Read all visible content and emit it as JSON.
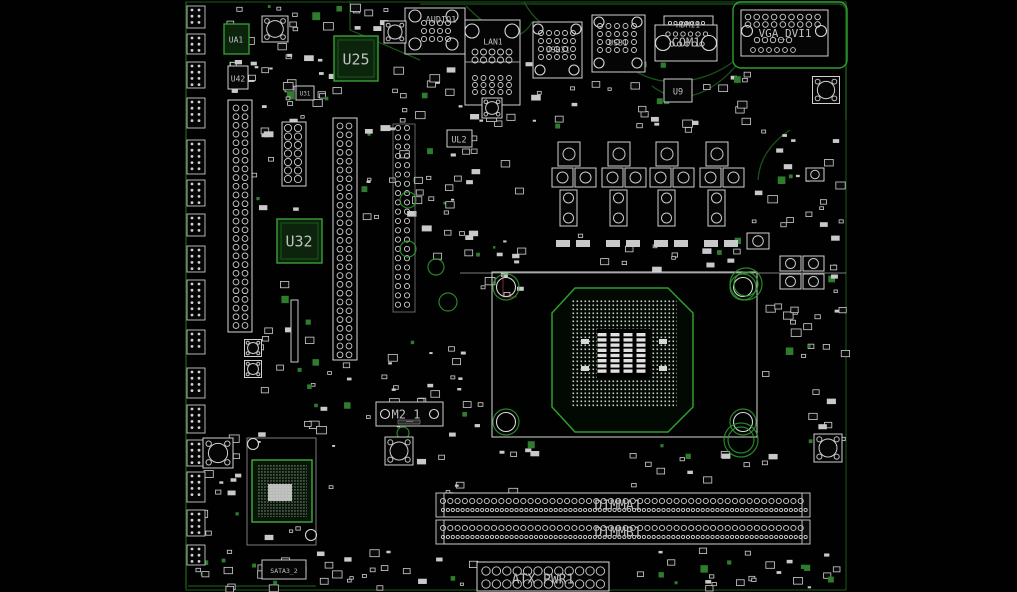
{
  "io": {
    "audio": "AUDIO1",
    "lan": "LAN1",
    "usb3": "USB31",
    "usb": "USB1",
    "hdmi": "HDMI1",
    "com": "COM1",
    "vga": "VGA_DVI1"
  },
  "chips": {
    "ua1": "UA1",
    "u42": "U42",
    "u31": "U31",
    "u25": "U25",
    "u9": "U9",
    "ul2": "UL2",
    "u32": "U32"
  },
  "slots": {
    "dimm_a": "DIMMA1",
    "dimm_b": "DIMMB1",
    "m2": "M2_1",
    "sata": "SATA3_2",
    "atx": "ATX PWR1"
  },
  "colors": {
    "board_outline": "#1a5c1a",
    "bright_green": "#3fae3f",
    "silkscreen": "#d0d0d0",
    "chip_fill": "#0c240c",
    "background": "#010101",
    "dimm_label": "#8fb48f"
  },
  "scene": {
    "board": {
      "x": 186,
      "y": 2,
      "w": 660,
      "h": 588
    },
    "clusters": [
      [
        218,
        4,
        115,
        96,
        40,
        1
      ],
      [
        392,
        58,
        255,
        66,
        40,
        2
      ],
      [
        650,
        62,
        95,
        66,
        18,
        3
      ],
      [
        250,
        100,
        80,
        110,
        16,
        4
      ],
      [
        360,
        125,
        92,
        100,
        20,
        5
      ],
      [
        420,
        132,
        100,
        135,
        24,
        6
      ],
      [
        745,
        130,
        98,
        98,
        22,
        7
      ],
      [
        760,
        300,
        84,
        168,
        26,
        8
      ],
      [
        828,
        232,
        17,
        78,
        8,
        9
      ],
      [
        362,
        340,
        118,
        98,
        28,
        10
      ],
      [
        415,
        438,
        118,
        58,
        14,
        11
      ],
      [
        188,
        428,
        148,
        115,
        28,
        12
      ],
      [
        190,
        548,
        288,
        40,
        38,
        13
      ],
      [
        620,
        548,
        224,
        40,
        28,
        14
      ],
      [
        480,
        240,
        40,
        58,
        8,
        15
      ],
      [
        255,
        272,
        58,
        116,
        13,
        16
      ],
      [
        300,
        362,
        58,
        66,
        10,
        17
      ],
      [
        620,
        440,
        128,
        44,
        12,
        18
      ],
      [
        540,
        232,
        200,
        36,
        14,
        19
      ],
      [
        308,
        4,
        80,
        30,
        10,
        20
      ]
    ],
    "headers": {
      "x": 187,
      "w": 18,
      "items": [
        [
          6,
          22
        ],
        [
          34,
          20
        ],
        [
          62,
          26
        ],
        [
          98,
          30
        ],
        [
          140,
          34
        ],
        [
          180,
          26
        ],
        [
          214,
          22
        ],
        [
          246,
          26
        ],
        [
          280,
          40
        ],
        [
          330,
          24
        ],
        [
          368,
          30
        ],
        [
          405,
          28
        ],
        [
          440,
          26
        ],
        [
          472,
          30
        ],
        [
          510,
          26
        ],
        [
          545,
          20
        ]
      ]
    },
    "iogrids": [
      [
        424,
        23,
        4,
        3,
        8,
        8,
        2.6
      ],
      [
        475,
        52,
        5,
        2,
        8.5,
        8,
        3
      ],
      [
        475,
        78,
        5,
        3,
        8.5,
        7,
        2.5
      ],
      [
        541,
        33,
        5,
        4,
        8,
        8,
        2.5
      ],
      [
        600,
        26,
        5,
        4,
        8.5,
        8,
        2.5
      ],
      [
        668,
        34,
        6,
        1,
        7.5,
        7,
        2.2
      ],
      [
        672,
        44,
        5,
        1,
        7.5,
        7,
        2.2
      ],
      [
        670,
        23,
        7,
        1,
        5.5,
        5,
        1.6
      ],
      [
        748,
        17,
        9,
        2,
        8.7,
        7.5,
        2.8
      ],
      [
        757,
        40,
        5,
        1,
        8,
        7,
        2.7
      ],
      [
        753,
        50,
        6,
        1,
        8,
        7,
        2.4
      ],
      [
        236,
        108,
        2,
        26,
        9,
        8.7,
        2.9
      ],
      [
        340,
        126,
        2,
        27,
        9,
        8.8,
        2.9
      ],
      [
        288,
        128,
        2,
        7,
        10,
        8.5,
        3.6
      ],
      [
        398,
        128,
        2,
        20,
        9,
        9.3,
        2.6
      ],
      [
        486,
        571,
        12,
        2,
        10.4,
        13,
        4.2
      ],
      [
        443,
        501,
        50,
        1,
        7.3,
        7,
        2.6
      ],
      [
        443,
        510,
        75,
        1,
        4.9,
        5,
        1.6
      ],
      [
        443,
        528,
        50,
        1,
        7.3,
        7,
        2.6
      ],
      [
        443,
        537,
        75,
        1,
        4.9,
        5,
        1.6
      ]
    ],
    "bigcircles": [
      [
        415,
        16,
        6
      ],
      [
        452,
        16,
        6
      ],
      [
        415,
        44,
        6
      ],
      [
        452,
        44,
        6
      ],
      [
        472,
        31,
        7
      ],
      [
        512,
        31,
        7
      ],
      [
        538,
        29,
        5
      ],
      [
        576,
        29,
        5
      ],
      [
        540,
        70,
        5
      ],
      [
        574,
        70,
        5
      ],
      [
        599,
        22,
        5
      ],
      [
        637,
        22,
        5
      ],
      [
        599,
        63,
        5
      ],
      [
        637,
        63,
        5
      ],
      [
        663,
        43,
        7.5
      ],
      [
        709,
        43,
        7.5
      ],
      [
        747,
        31,
        5.5
      ],
      [
        821,
        31,
        5.5
      ],
      [
        385,
        414,
        4.5
      ],
      [
        434,
        414,
        4.5
      ],
      [
        253,
        444,
        5.5
      ],
      [
        311,
        535,
        5.5
      ],
      [
        506,
        287,
        9.5
      ],
      [
        743,
        287,
        9.5
      ],
      [
        506,
        422,
        9.5
      ],
      [
        743,
        422,
        9.5
      ]
    ],
    "rings": [
      [
        506,
        287,
        13
      ],
      [
        743,
        287,
        13
      ],
      [
        506,
        422,
        13
      ],
      [
        743,
        422,
        13
      ],
      [
        408,
        200,
        8
      ],
      [
        408,
        249,
        8
      ],
      [
        436,
        267,
        8
      ],
      [
        448,
        302,
        9
      ],
      [
        746,
        284,
        12
      ],
      [
        746,
        284,
        16
      ],
      [
        741,
        440,
        13
      ],
      [
        741,
        440,
        17
      ],
      [
        403,
        433,
        6
      ]
    ],
    "machines": [
      [
        275,
        29,
        26
      ],
      [
        826,
        90,
        27
      ],
      [
        218,
        453,
        30
      ],
      [
        399,
        451,
        28
      ],
      [
        828,
        448,
        28
      ],
      [
        253,
        348,
        17
      ],
      [
        253,
        369,
        17
      ],
      [
        395,
        32,
        22
      ],
      [
        492,
        108,
        20
      ]
    ],
    "capsquares": [
      [
        780,
        256,
        21,
        15
      ],
      [
        803,
        256,
        21,
        15
      ],
      [
        780,
        274,
        21,
        15
      ],
      [
        803,
        274,
        21,
        15
      ],
      [
        747,
        233,
        22,
        16
      ],
      [
        806,
        168,
        18,
        13
      ]
    ],
    "traces": [
      "M420,4 L838,4",
      "M838,4 Q846,4 846,12 L846,120",
      "M466,6 C500,40 520,44 532,22",
      "M620,58 C650,92 700,86 733,62",
      "M736,66 C700,106 670,100 652,86",
      "M524,2 C540,30 560,36 580,30",
      "M186,2 L186,588",
      "M188,586 L316,586",
      "M350,2 L350,30 L420,60",
      "M790,130 Q760,150 758,180"
    ],
    "vrm": {
      "y": 140,
      "xs": [
        552,
        602,
        650,
        700
      ]
    },
    "cpu_pads": {
      "cols": [
        602,
        615,
        628,
        641
      ],
      "y0": 333,
      "rows": 8,
      "dy": 5.2,
      "w": 9,
      "h": 3.4
    }
  }
}
